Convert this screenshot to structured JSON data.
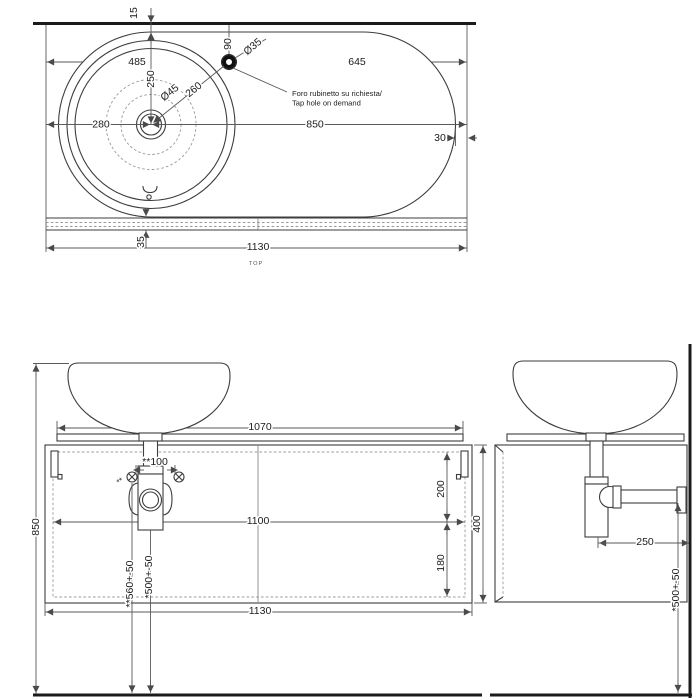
{
  "drawing": {
    "type": "technical-drawing-washbasin-console",
    "colors": {
      "line": "#3d3d3d",
      "dim": "#5a5a5a",
      "wall": "#1b1b1b",
      "dashed": "#9a9a9a"
    }
  },
  "top": {
    "view_label": "TOP",
    "note1": "Foro rubinetto su richiesta/",
    "note2": "Tap hole on demand",
    "gap15": "15",
    "d485": "485",
    "d250": "250",
    "d90": "90",
    "dia35": "Ø35",
    "d645": "645",
    "d280": "280",
    "dia45": "Ø45",
    "d260": "260",
    "d850": "850",
    "d30": "30",
    "d35": "35",
    "d1130": "1130"
  },
  "front": {
    "h850": "850",
    "w1070": "1070",
    "screw_span": "**100",
    "screw_marks": "**",
    "w1100": "1100",
    "d200": "200",
    "d180": "180",
    "h400": "400",
    "h560": "**560+-50",
    "h500": "*500+-50",
    "w1130": "1130"
  },
  "side": {
    "d250": "250",
    "h500": "*500+-50"
  }
}
